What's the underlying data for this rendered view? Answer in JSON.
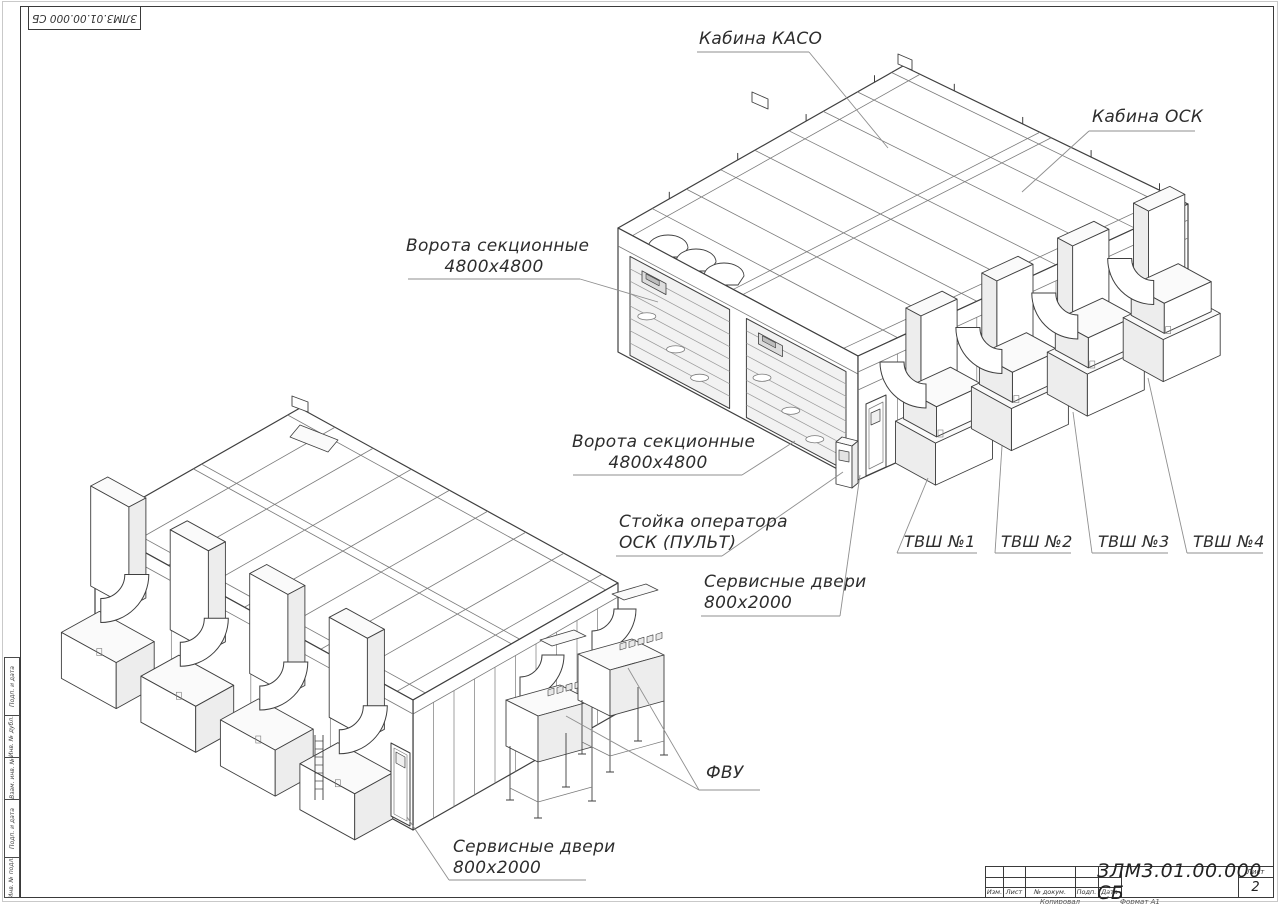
{
  "doc": {
    "stamp_top_left": "ЗЛМ3.01.00.000 СБ"
  },
  "callouts": {
    "kaso": "Кабина КАСО",
    "osk": "Кабина ОСК",
    "gates1": {
      "line1": "Ворота секционные",
      "line2": "4800х4800"
    },
    "gates2": {
      "line1": "Ворота секционные",
      "line2": "4800х4800"
    },
    "operator": {
      "line1": "Стойка оператора",
      "line2": "ОСК (ПУЛЬТ)"
    },
    "service1": {
      "line1": "Сервисные двери",
      "line2": "800х2000"
    },
    "service2": {
      "line1": "Сервисные двери",
      "line2": "800х2000"
    },
    "tvsh1": "ТВШ №1",
    "tvsh2": "ТВШ №2",
    "tvsh3": "ТВШ №3",
    "tvsh4": "ТВШ №4",
    "fvu": "ФВУ"
  },
  "title_block": {
    "doc_number": "ЗЛМ3.01.00.000 СБ",
    "sheet_label": "Лист",
    "sheet_number": "2",
    "columns": [
      "Изм.",
      "Лист",
      "№ докум.",
      "Подп.",
      "Дата"
    ],
    "copied_label": "Копировал",
    "format_label": "Формат А1"
  },
  "margin_labels": [
    "Подп. и дата",
    "Инв. № дубл.",
    "Взам. инв. №",
    "Подп. и дата",
    "Инв. № подл."
  ]
}
